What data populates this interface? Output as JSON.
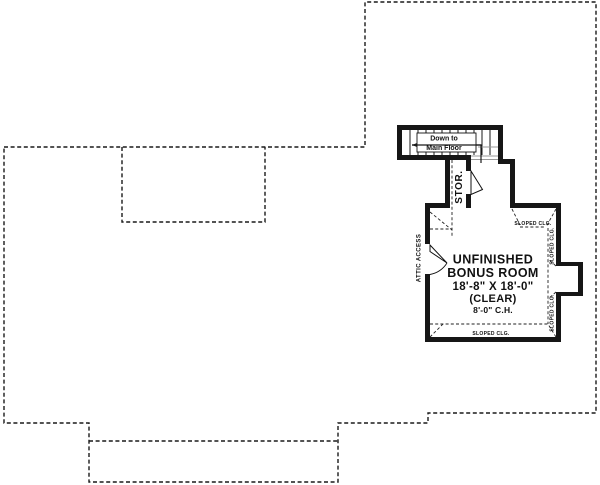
{
  "plan": {
    "stair": {
      "down_to": "Down to",
      "main_floor": "Main Floor"
    },
    "storage_label": "STOR.",
    "attic_access_label": "ATTIC ACCESS",
    "room": {
      "name_line1": "UNFINISHED",
      "name_line2": "BONUS ROOM",
      "dimensions": "18'-8\" X 18'-0\"",
      "clear": "(CLEAR)",
      "ceiling_height": "8'-0\" C.H."
    },
    "sloped_clg": [
      "SLOPED CLG.",
      "SLOPED CLG.",
      "SLOPED CLG.",
      "SLOPED CLG."
    ],
    "colors": {
      "wall": "#161616",
      "line": "#222222",
      "background": "#ffffff"
    }
  }
}
